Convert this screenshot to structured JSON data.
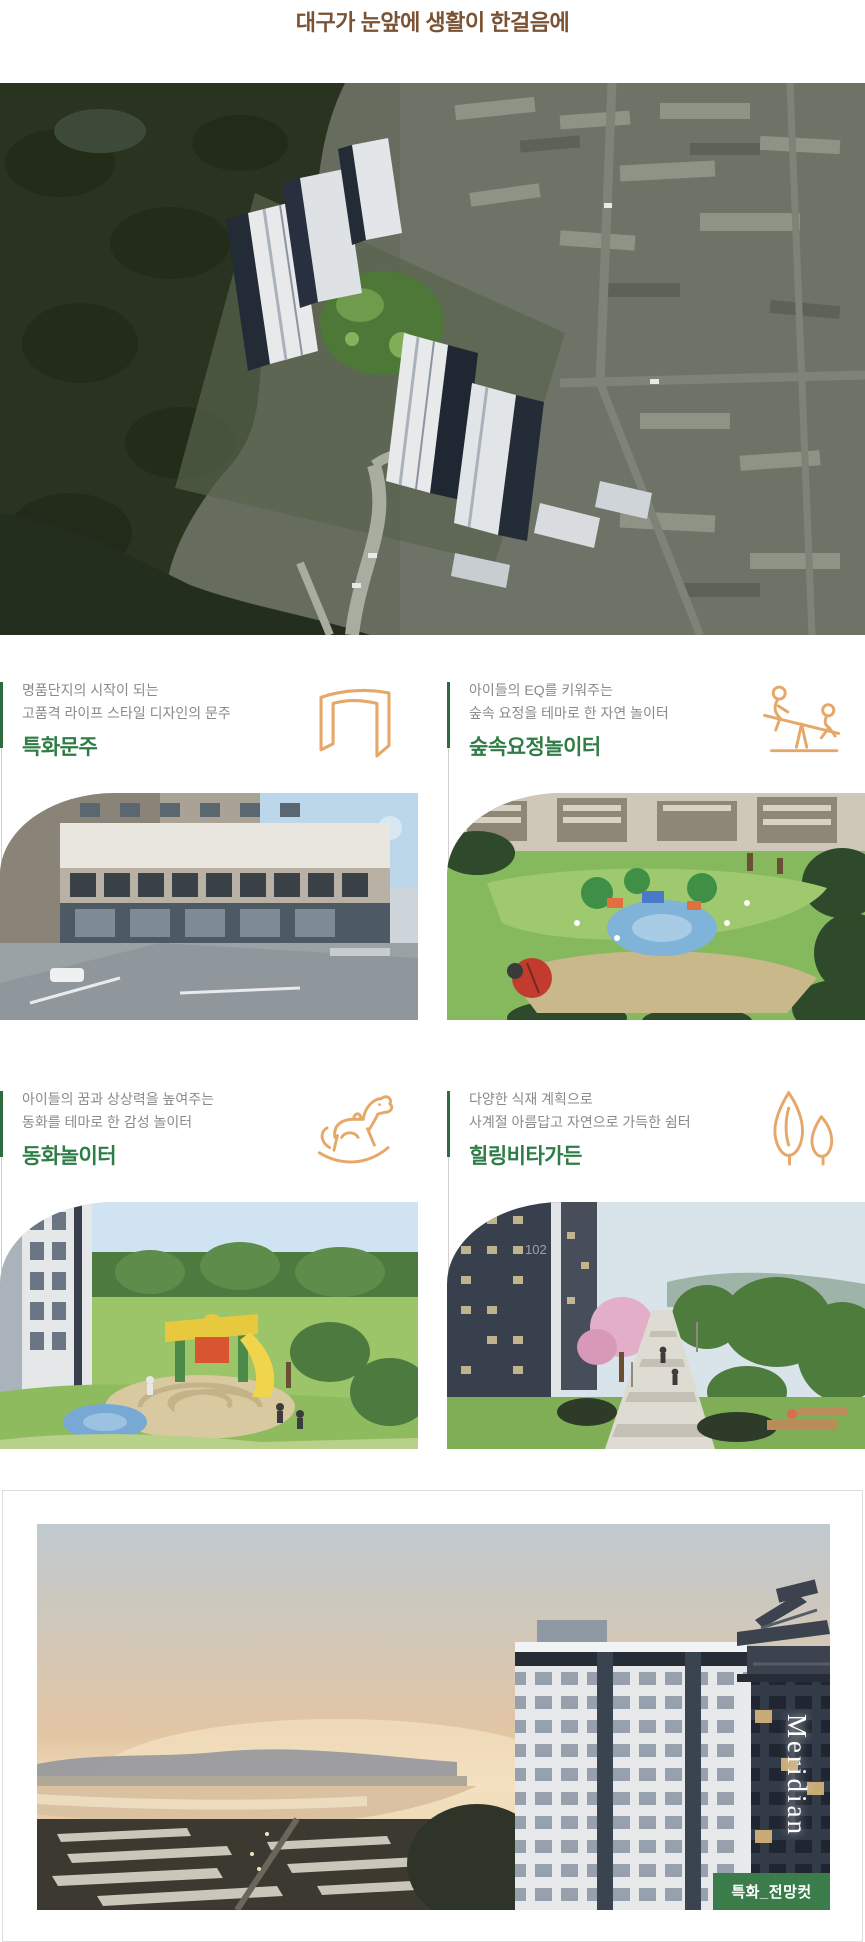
{
  "page_title": {
    "text": "대구가 눈앞에 생활이 한걸음에"
  },
  "hero": {
    "image": "aerial-complex-rendering"
  },
  "features": [
    {
      "desc1": "명품단지의 시작이 되는",
      "desc2": "고품격 라이프 스타일 디자인의 문주",
      "title": "특화문주",
      "icon": "gate-icon",
      "photo": "gate-street-view"
    },
    {
      "desc1": "아이들의 EQ를 키워주는",
      "desc2": "숲속 요정을 테마로 한 자연 놀이터",
      "title": "숲속요정놀이터",
      "icon": "seesaw-icon",
      "photo": "forest-playground-view"
    },
    {
      "desc1": "아이들의 꿈과 상상력을 높여주는",
      "desc2": "동화를 테마로 한 감성 놀이터",
      "title": "동화놀이터",
      "icon": "rocking-horse-icon",
      "photo": "fairytale-playground-view"
    },
    {
      "desc1": "다양한 식재 계획으로",
      "desc2": "사계절 아름답고 자연으로 가득한 쉼터",
      "title": "힐링비타가든",
      "icon": "trees-icon",
      "photo": "vita-garden-view",
      "building_number": "102"
    }
  ],
  "panorama": {
    "brand_text": "Meridian",
    "badge_label": "특화_전망컷"
  },
  "colors": {
    "title_brown": "#7b5233",
    "desc_gray": "#8a8a8a",
    "heading_green": "#2e7d46",
    "accent_line_green": "#2e6b3e",
    "divider_gray": "#cfcfcf",
    "icon_orange": "#e5a868",
    "badge_green": "#3a7c4a",
    "card_border": "#dcdcdc"
  }
}
